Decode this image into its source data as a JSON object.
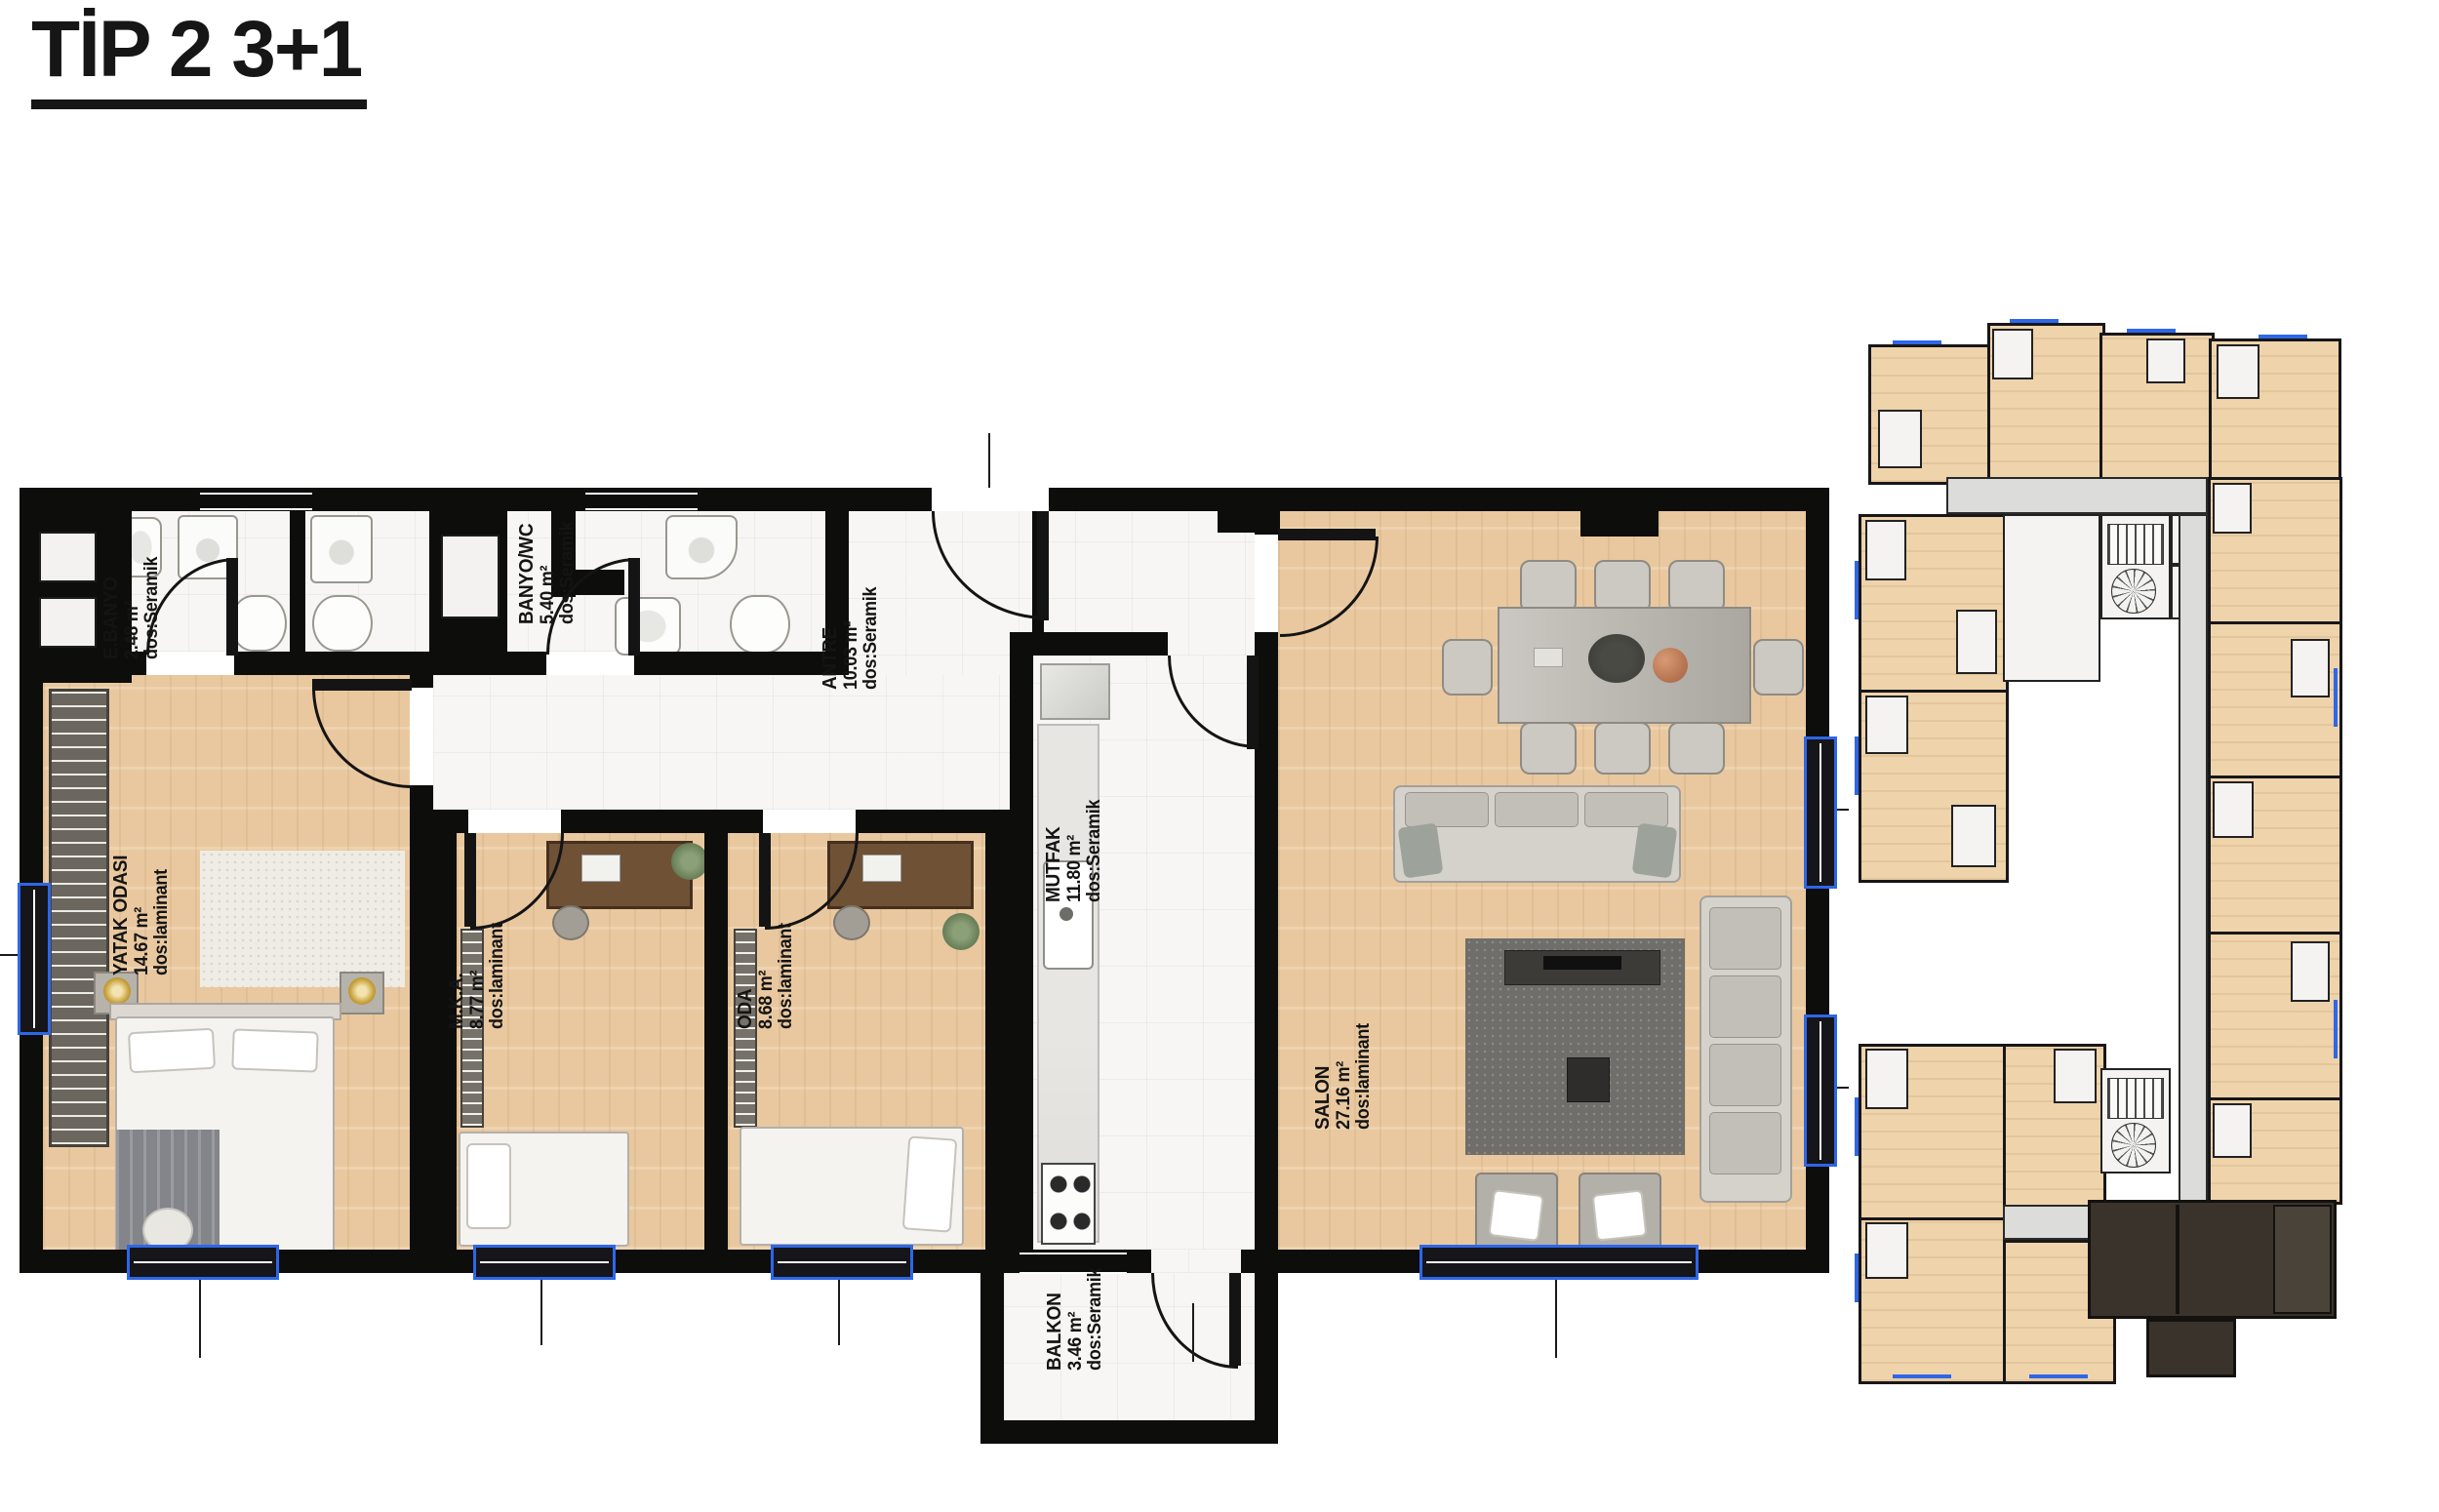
{
  "title": "TİP 2 3+1",
  "floor_plan": {
    "rooms": [
      {
        "name": "E.BANYO",
        "area": "2.48 m²",
        "floor": "dos:Seramik"
      },
      {
        "name": "BANYO/WC",
        "area": "5.40 m²",
        "floor": "dos:Seramik"
      },
      {
        "name": "ANTRE",
        "area": "10.03 m²",
        "floor": "dos:Seramik"
      },
      {
        "name": "YATAK ODASI",
        "area": "14.67 m²",
        "floor": "dos:laminant"
      },
      {
        "name": "M.K.A.",
        "area": "8.77 m²",
        "floor": "dos:laminant"
      },
      {
        "name": "ODA",
        "area": "8.68 m²",
        "floor": "dos:laminant"
      },
      {
        "name": "MUTFAK",
        "area": "11.80 m²",
        "floor": "dos:Seramik"
      },
      {
        "name": "SALON",
        "area": "27.16 m²",
        "floor": "dos:laminant"
      },
      {
        "name": "BALKON",
        "area": "3.46 m²",
        "floor": "dos:Seramik"
      }
    ]
  },
  "colors": {
    "wall": "#0d0d0c",
    "wood_floor": "#e9c89f",
    "tile_floor": "#f7f6f4",
    "window_accent": "#2e66e8",
    "keyplan_corridor": "#dcdcda",
    "keyplan_highlight_unit": "#39332b"
  }
}
